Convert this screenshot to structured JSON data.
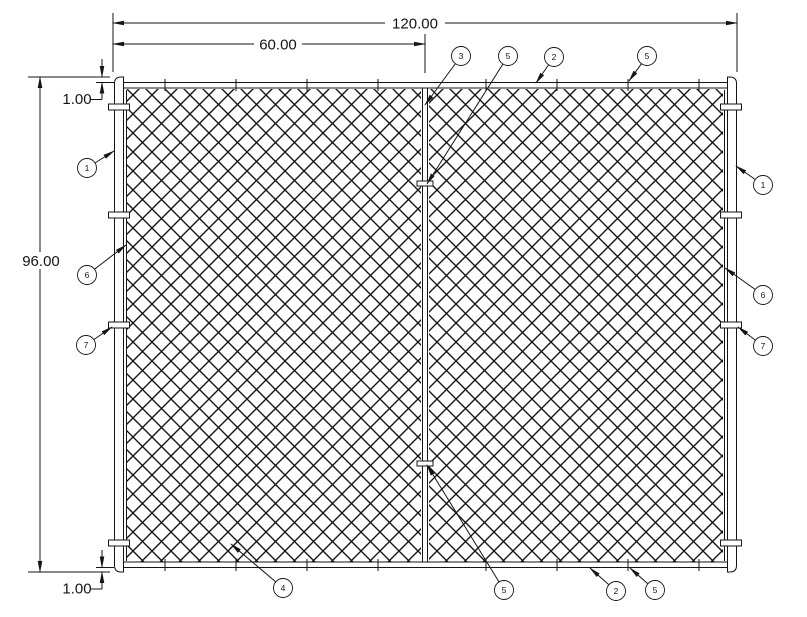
{
  "drawing": {
    "background_color": "#ffffff",
    "line_color": "#151515"
  },
  "dims": {
    "overall_width": "120.00",
    "mid_span": "60.00",
    "height": "96.00",
    "top_offset": "1.00",
    "bottom_offset": "1.00"
  },
  "callouts": {
    "top": [
      "3",
      "5",
      "2",
      "5"
    ],
    "left": [
      "1",
      "6",
      "7"
    ],
    "right": [
      "1",
      "6",
      "7"
    ],
    "bottom": [
      "4",
      "5",
      "2",
      "5"
    ]
  }
}
